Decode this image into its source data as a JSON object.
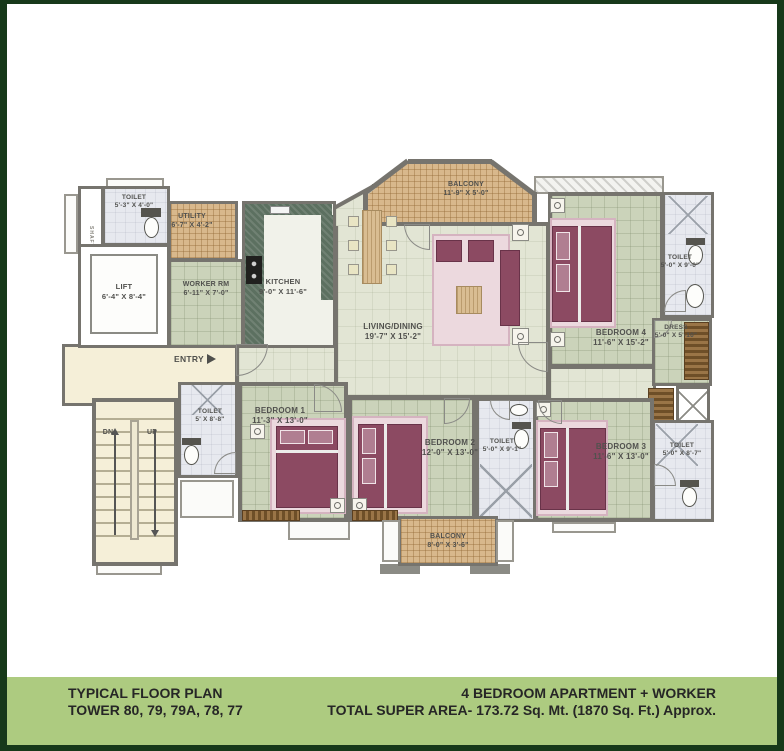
{
  "colors": {
    "frame_green": "#17391a",
    "footer_green": "#adcb80",
    "wall_gray": "#76746e",
    "bedroom_tile": "#cbd3ba",
    "balcony_tile": "#d8b88c",
    "corridor_cream": "#f5efd8",
    "bed_maroon": "#8c4a62",
    "rug_pink": "#ecd9de"
  },
  "footer": {
    "left_line1": "TYPICAL FLOOR PLAN",
    "left_line2": "TOWER 80, 79, 79A, 78, 77",
    "right_line1": "4 BEDROOM APARTMENT + WORKER",
    "right_line2": "TOTAL SUPER AREA- 173.72 Sq. Mt. (1870 Sq. Ft.) Approx."
  },
  "plan": {
    "entry_label": "ENTRY",
    "shaft_label": "SHAFT",
    "stairs": {
      "dn": "DN",
      "up": "UP"
    },
    "rooms": {
      "toilet_lobby": {
        "name": "TOILET",
        "dims": "5'-3\" X 4'-0\""
      },
      "utility": {
        "name": "UTILITY",
        "dims": "6'-7\" X 4'-2\""
      },
      "lift": {
        "name": "LIFT",
        "dims": "6'-4\" X 8'-4\""
      },
      "worker": {
        "name": "WORKER RM",
        "dims": "6'-11\" X 7'-0\""
      },
      "kitchen": {
        "name": "KITCHEN",
        "dims": "9'-0\" X 11'-6\""
      },
      "balcony_top": {
        "name": "BALCONY",
        "dims": "11'-9\" X 5'-0\""
      },
      "living": {
        "name": "LIVING/DINING",
        "dims": "19'-7\" X 15'-2\""
      },
      "bedroom4": {
        "name": "BEDROOM 4",
        "dims": "11'-6\" X 15'-2\""
      },
      "toilet_b4": {
        "name": "TOILET",
        "dims": "5'-0\" X 9'-0\""
      },
      "dress": {
        "name": "DRESS",
        "dims": "5'-0\" X 5'-10\""
      },
      "toilet_b1": {
        "name": "TOILET",
        "dims": "5' X 8'-8\""
      },
      "bedroom1": {
        "name": "BEDROOM 1",
        "dims": "11'-3\" X 13'-0\""
      },
      "bedroom2": {
        "name": "BEDROOM 2",
        "dims": "12'-0\" X 13'-0\""
      },
      "toilet_b2": {
        "name": "TOILET",
        "dims": "5'-0\" X 9'-1\""
      },
      "bedroom3": {
        "name": "BEDROOM 3",
        "dims": "11'-6\" X 13'-0\""
      },
      "toilet_b3": {
        "name": "TOILET",
        "dims": "5'-0\" X 8'-7\""
      },
      "balcony_rear": {
        "name": "BALCONY",
        "dims": "8'-0\" X 3'-6\""
      }
    }
  }
}
